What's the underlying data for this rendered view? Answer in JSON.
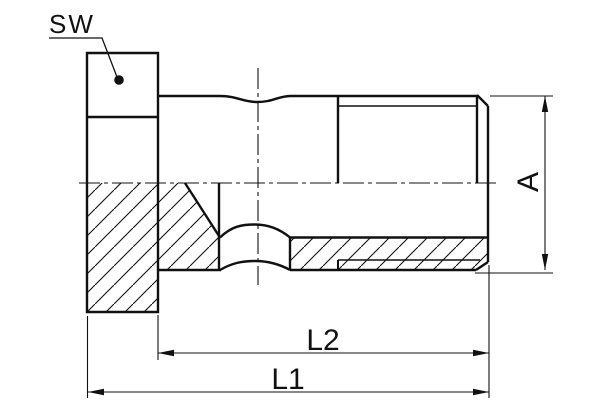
{
  "drawing": {
    "type": "technical-drawing-half-section",
    "part": "hex-head hollow screw plug / fitting",
    "labels": {
      "wrench_size": "SW",
      "diameter": "A",
      "length_thread": "L2",
      "length_overall": "L1"
    },
    "colors": {
      "line": "#111111",
      "background": "#ffffff"
    }
  }
}
